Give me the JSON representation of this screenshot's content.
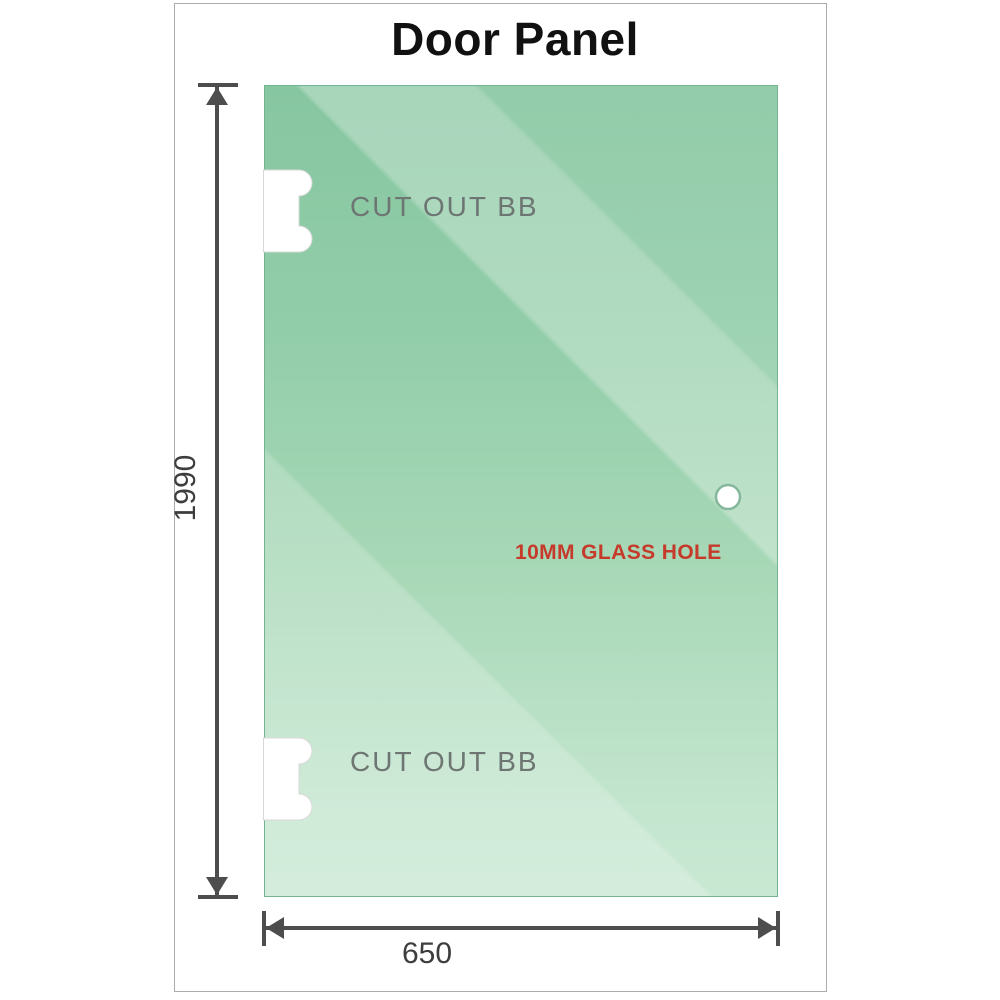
{
  "title": "Door Panel",
  "glass_panel": {
    "cutouts": [
      {
        "label": "CUT OUT BB"
      },
      {
        "label": "CUT OUT BB"
      }
    ],
    "hole": {
      "label": "10MM GLASS HOLE"
    }
  },
  "dimensions": {
    "height": {
      "label": "1990"
    },
    "width": {
      "label": "650"
    }
  },
  "colors": {
    "title": "#111111",
    "frame-border": "#ababab",
    "glass-top": "#86c6a0",
    "glass-bottom": "#c9e8d3",
    "panel-border": "#74b391",
    "cutout-label": "#6e7673",
    "hole-label": "#c53a2b",
    "dim": "#4d4d4d",
    "dim-label": "#3d3d3d"
  }
}
